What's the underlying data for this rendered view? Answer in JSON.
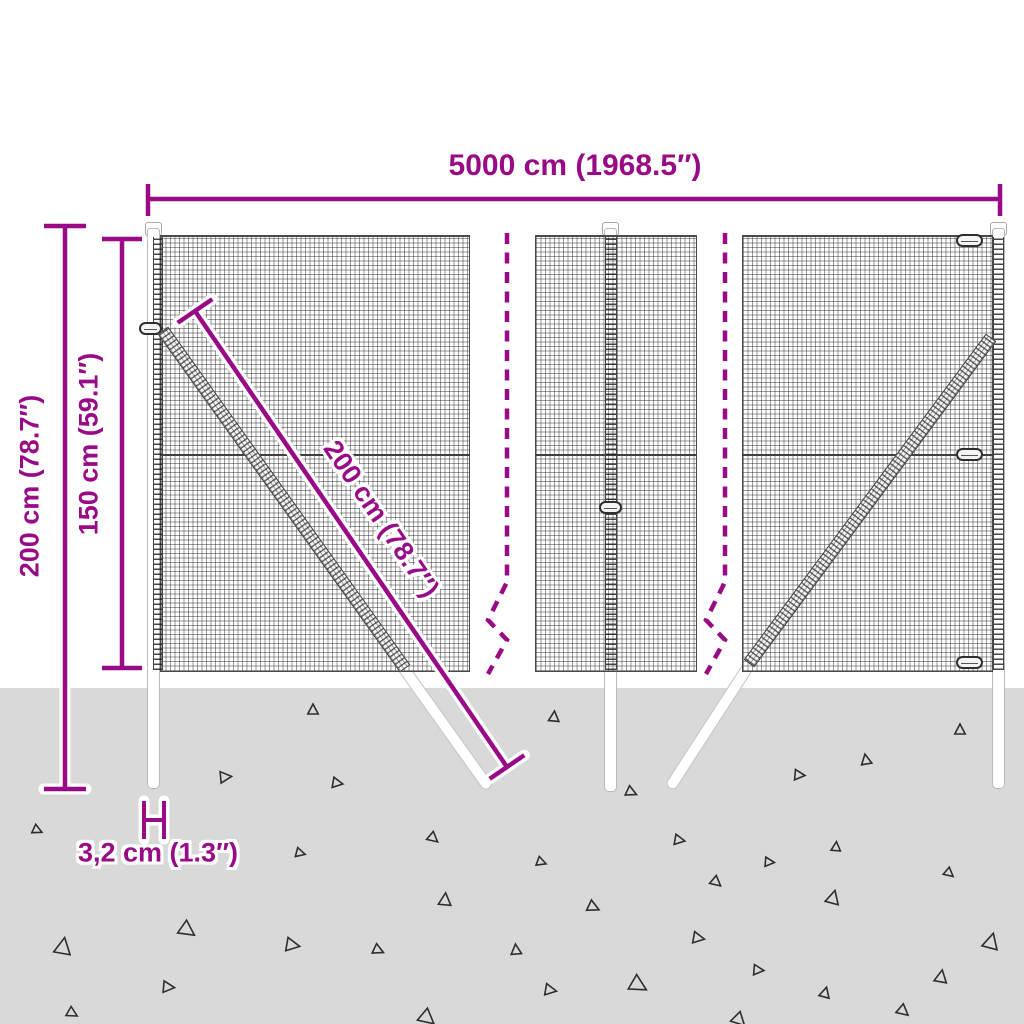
{
  "title": "Wire mesh fence dimension diagram",
  "colors": {
    "accent": "#990b86",
    "ground": "#d9d9d9",
    "mesh_line": "#2d2d2d",
    "post_fill": "#ffffff",
    "post_border": "#b9b9b9",
    "triangle_outline": "#2e2e2e"
  },
  "labels": {
    "total_width": "5000 cm (1968.5″)",
    "total_height": "200 cm (78.7″)",
    "mesh_height": "150 cm (59.1″)",
    "diagonal_length": "200 cm (78.7″)",
    "post_width": "3,2 cm (1.3″)"
  },
  "ground": {
    "triangles": [
      [
        313,
        710,
        1.0,
        0
      ],
      [
        225,
        777,
        1.1,
        85
      ],
      [
        337,
        783,
        1.0,
        100
      ],
      [
        37,
        830,
        0.9,
        115
      ],
      [
        433,
        838,
        1.0,
        130
      ],
      [
        300,
        853,
        0.9,
        105
      ],
      [
        445,
        900,
        1.2,
        5
      ],
      [
        187,
        930,
        1.5,
        125
      ],
      [
        292,
        945,
        1.3,
        100
      ],
      [
        378,
        950,
        1.0,
        115
      ],
      [
        63,
        947,
        1.6,
        10
      ],
      [
        168,
        987,
        1.1,
        95
      ],
      [
        72,
        1013,
        1.0,
        120
      ],
      [
        427,
        1018,
        1.5,
        130
      ],
      [
        554,
        717,
        1.0,
        5
      ],
      [
        960,
        730,
        1.0,
        0
      ],
      [
        866,
        760,
        1.0,
        350
      ],
      [
        799,
        775,
        1.0,
        95
      ],
      [
        631,
        792,
        1.0,
        115
      ],
      [
        679,
        840,
        1.0,
        100
      ],
      [
        541,
        862,
        0.9,
        110
      ],
      [
        836,
        847,
        0.9,
        5
      ],
      [
        769,
        862,
        0.9,
        95
      ],
      [
        949,
        873,
        0.9,
        130
      ],
      [
        716,
        882,
        1.0,
        130
      ],
      [
        833,
        898,
        1.3,
        15
      ],
      [
        593,
        907,
        1.1,
        115
      ],
      [
        698,
        938,
        1.1,
        100
      ],
      [
        516,
        950,
        1.0,
        355
      ],
      [
        991,
        942,
        1.5,
        15
      ],
      [
        758,
        970,
        1.0,
        95
      ],
      [
        638,
        985,
        1.6,
        120
      ],
      [
        941,
        977,
        1.2,
        10
      ],
      [
        550,
        990,
        1.1,
        100
      ],
      [
        825,
        993,
        1.0,
        15
      ],
      [
        903,
        1011,
        1.1,
        130
      ],
      [
        739,
        1020,
        1.3,
        135
      ]
    ]
  }
}
